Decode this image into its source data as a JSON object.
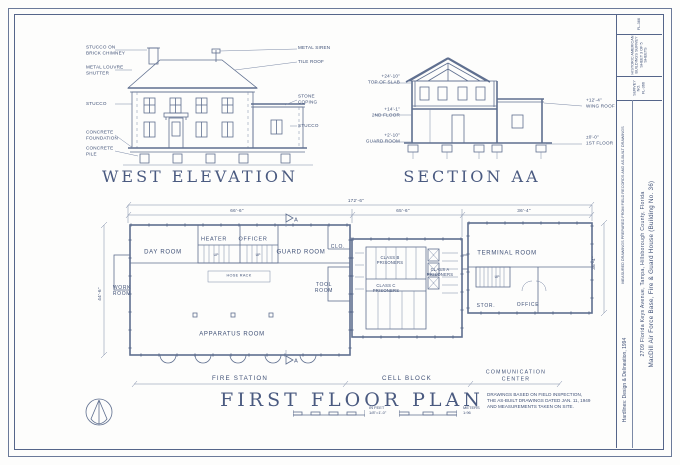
{
  "west_elevation": {
    "title": "WEST ELEVATION",
    "labels_left": [
      "STUCCO ON\nBRICK CHIMNEY",
      "METAL LOUVRE\nSHUTTER",
      "STUCCO",
      "CONCRETE\nFOUNDATION",
      "CONCRETE\nPILE"
    ],
    "labels_right": [
      "METAL SIREN",
      "TILE ROOF",
      "STONE\nCOPING",
      "STUCCO"
    ]
  },
  "section_aa": {
    "title": "SECTION AA",
    "labels_left": [
      "+24'-10\"\nTOP OF SLAB",
      "+14'-1\"\n2ND FLOOR",
      "+2'-10\"\nGUARD ROOM"
    ],
    "labels_right": [
      "+12'-4\"\nWING ROOF",
      "±0'-0\"\n1ST FLOOR"
    ]
  },
  "floor_plan": {
    "title": "FIRST FLOOR PLAN",
    "dimensions": {
      "overall": "172'-6\"",
      "fire_station": "66'-6\"",
      "cell_block": "65'-6\"",
      "comm_center": "36'-4\"",
      "left_side": "44'-6\"",
      "right_side": "36'-4\""
    },
    "rooms": {
      "day_room": "DAY ROOM",
      "heater": "HEATER",
      "officer": "OFFICER",
      "guard_room": "GUARD ROOM",
      "closet": "CLO.",
      "work_room": "WORK\nROOM",
      "tool_room": "TOOL\nROOM",
      "apparatus_room": "APPARATUS ROOM",
      "hose_rack": "HOSE RACK",
      "class_b": "CLASS B\nPRISONERS",
      "class_c": "CLASS C\nPRISONERS",
      "class_a": "CLASS A\nPRISONERS",
      "terminal_room": "TERMINAL ROOM",
      "storage": "STOR.",
      "office": "OFFICE"
    },
    "up_label": "UP",
    "section_marker": "A",
    "zones": [
      "FIRE STATION",
      "CELL BLOCK",
      "COMMUNICATION\nCENTER"
    ],
    "scale_feet_label": "IN FEET\n1/8\"=1'-0\"",
    "scale_meters_label": "METERS\n1:96"
  },
  "notes": "DRAWINGS BASED ON FIELD INSPECTION,\nTHE AS-BUILT DRAWINGS DATED JAN. 11, 1949\nAND MEASUREMENTS TAKEN ON SITE.",
  "title_block": {
    "tag": "FL-366",
    "survey": "HISTORIC AMERICAN\nBUILDINGS SURVEY\nSHEET 3 OF 5 SHEETS",
    "survey_no": "SURVEY NO.\nFL-366",
    "project_title": "MacDill Air Force Base,  Fire & Guard House  (Building No. 36)",
    "project_address": "2709 Florida Keys Avenue,  Tampa,  Hillsborough County,  Florida",
    "credit": "MEASURED DRAWINGS PREPARED FROM FIELD RECORDS AND AS-BUILT DRAWINGS",
    "firm": "Hardlines: Design & Delineation, 1994"
  }
}
